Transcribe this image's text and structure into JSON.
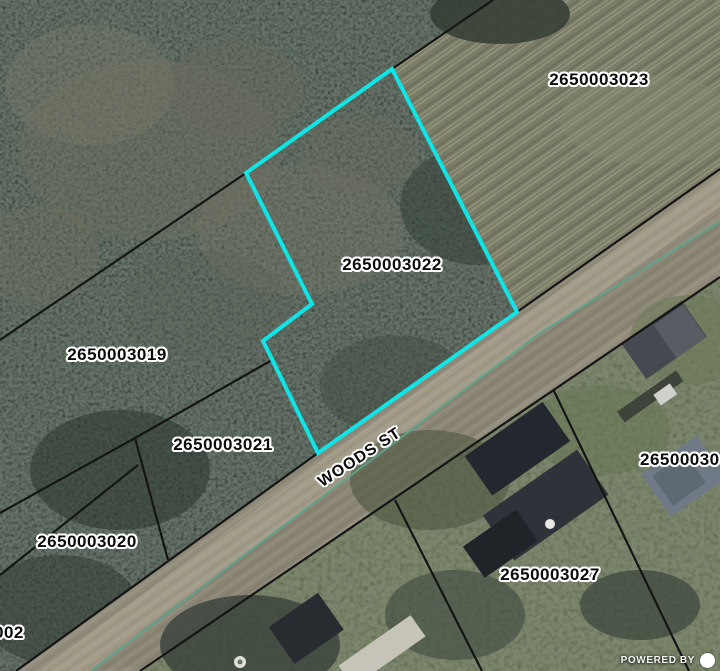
{
  "map": {
    "parcel_labels": [
      {
        "id": "2650003023",
        "x": 599,
        "y": 80
      },
      {
        "id": "2650003022",
        "x": 392,
        "y": 265
      },
      {
        "id": "2650003019",
        "x": 117,
        "y": 355
      },
      {
        "id": "2650003021",
        "x": 223,
        "y": 445
      },
      {
        "id": "2650003020",
        "x": 87,
        "y": 542
      },
      {
        "id": "2650003027",
        "x": 550,
        "y": 575
      },
      {
        "id": "26500030",
        "x": 640,
        "y": 460,
        "edge": "right"
      },
      {
        "id": "002",
        "x": -6,
        "y": 633,
        "edge": "left"
      }
    ],
    "street_label": {
      "text": "WOODS ST",
      "x": 360,
      "y": 458,
      "rotation_deg": -33
    },
    "selected_parcel": {
      "id": "2650003022",
      "outline_color": "#0fe4e6",
      "outline_width": 4,
      "vertices": [
        [
          392,
          69
        ],
        [
          246,
          173
        ],
        [
          312,
          304
        ],
        [
          263,
          341
        ],
        [
          318,
          453
        ],
        [
          517,
          312
        ]
      ]
    },
    "boundaries": {
      "color": "#151515",
      "width": 2.2,
      "segments": [
        [
          [
            0,
            340
          ],
          [
            246,
            173
          ]
        ],
        [
          [
            392,
            69
          ],
          [
            493,
            0
          ]
        ],
        [
          [
            16,
            671
          ],
          [
            318,
            453
          ]
        ],
        [
          [
            517,
            312
          ],
          [
            720,
            169
          ]
        ],
        [
          [
            140,
            671
          ],
          [
            720,
            277
          ]
        ],
        [
          [
            0,
            513
          ],
          [
            135,
            438
          ],
          [
            272,
            360
          ]
        ],
        [
          [
            135,
            438
          ],
          [
            168,
            560
          ]
        ],
        [
          [
            0,
            575
          ],
          [
            138,
            465
          ]
        ],
        [
          [
            554,
            391
          ],
          [
            689,
            671
          ]
        ],
        [
          [
            395,
            500
          ],
          [
            482,
            671
          ]
        ]
      ]
    },
    "road_centerline": {
      "color": "#5aa58e",
      "width": 2,
      "points": [
        [
          91,
          671
        ],
        [
          540,
          333
        ],
        [
          720,
          222
        ]
      ]
    },
    "attribution": {
      "text": "POWERED BY"
    },
    "colors": {
      "forest": "#2e3a33",
      "field": "#7b7c67",
      "road": "#918b7b",
      "grass": "#5a664c",
      "label_halo": "#ffffff",
      "attribution_text": "#ffffff"
    }
  }
}
